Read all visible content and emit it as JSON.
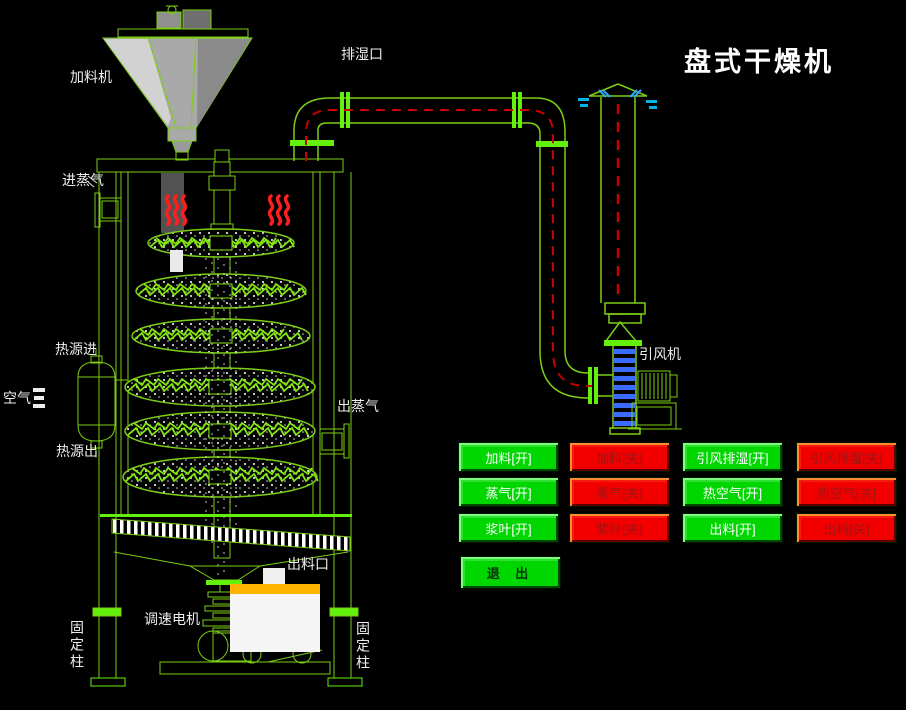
{
  "title": "盘式干燥机",
  "labels": {
    "feeder": "加料机",
    "moisture_outlet": "排湿口",
    "steam_inlet": "进蒸气",
    "heat_source_in": "热源进",
    "air": "空气",
    "heat_source_out": "热源出",
    "steam_outlet": "出蒸气",
    "discharge_port": "出料口",
    "speed_motor": "调速电机",
    "fixed_column_left": "固定柱",
    "fixed_column_right": "固定柱",
    "draft_fan": "引风机"
  },
  "buttons": {
    "items": [
      {
        "label": "加料[开]",
        "state": "on"
      },
      {
        "label": "加料[关]",
        "state": "off"
      },
      {
        "label": "引风排湿[开]",
        "state": "on"
      },
      {
        "label": "引风排湿[关]",
        "state": "off"
      },
      {
        "label": "蒸气[开]",
        "state": "on"
      },
      {
        "label": "蒸气[关]",
        "state": "off"
      },
      {
        "label": "热空气[开]",
        "state": "on"
      },
      {
        "label": "热空气[关]",
        "state": "off"
      },
      {
        "label": "浆叶[开]",
        "state": "on"
      },
      {
        "label": "浆叶[关]",
        "state": "off"
      },
      {
        "label": "出料[开]",
        "state": "on"
      },
      {
        "label": "出料[关]",
        "state": "off"
      }
    ],
    "exit_label": "退 出"
  },
  "colors": {
    "background": "#000000",
    "line_green": "#7cce14",
    "bright_green": "#63f00c",
    "button_green": "#00d600",
    "button_red": "#f20000",
    "heat_red": "#ff1e1e",
    "centerline_red": "#c80000",
    "rung_blue": "#3a6bff",
    "exhaust_cyan": "#00b4e8",
    "hopper_gray": "#a9a9a9",
    "cart_band_orange": "#ffb400",
    "label_white": "#ededed"
  }
}
